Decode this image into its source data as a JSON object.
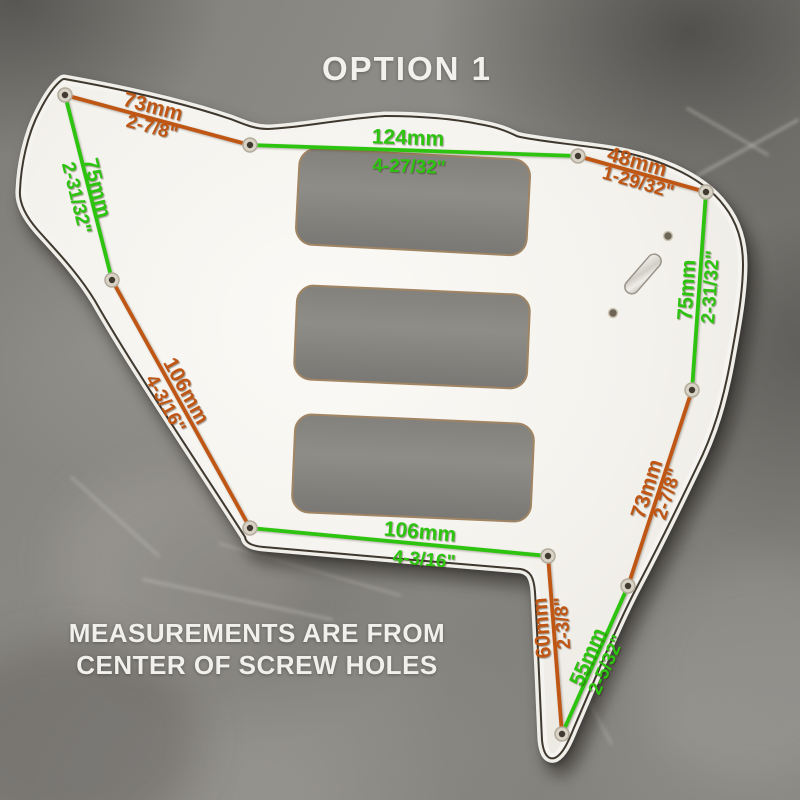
{
  "title": "OPTION 1",
  "footer": {
    "line1": "MEASUREMENTS ARE FROM",
    "line2": "CENTER OF SCREW HOLES"
  },
  "colors": {
    "orange": "#c05614",
    "green": "#2cc40f",
    "overlay_text": "#f2f1ee",
    "pickguard_white": "#f5f3ee",
    "ply_line": "#3f382e",
    "stone_gray": "#85837e"
  },
  "measurements": [
    {
      "name": "top-left-span",
      "color": "orange",
      "mm": "73mm",
      "inch": "2-7/8\"",
      "line": {
        "x1": 65,
        "y1": 95,
        "x2": 250,
        "y2": 145
      },
      "mm_label": {
        "x": 153,
        "y": 107,
        "rot": 15
      },
      "inch_label": {
        "x": 152,
        "y": 128,
        "rot": 15
      }
    },
    {
      "name": "neck-span",
      "color": "green",
      "mm": "124mm",
      "inch": "4-27/32\"",
      "line": {
        "x1": 250,
        "y1": 145,
        "x2": 578,
        "y2": 156
      },
      "mm_label": {
        "x": 408,
        "y": 138,
        "rot": 2
      },
      "inch_label": {
        "x": 409,
        "y": 167,
        "rot": 2
      }
    },
    {
      "name": "top-right-span",
      "color": "orange",
      "mm": "48mm",
      "inch": "1-29/32\"",
      "line": {
        "x1": 578,
        "y1": 156,
        "x2": 706,
        "y2": 192
      },
      "mm_label": {
        "x": 637,
        "y": 162,
        "rot": 16
      },
      "inch_label": {
        "x": 638,
        "y": 183,
        "rot": 16
      }
    },
    {
      "name": "left-edge-span",
      "color": "green",
      "mm": "75mm",
      "inch": "2-31/32\"",
      "line": {
        "x1": 65,
        "y1": 95,
        "x2": 112,
        "y2": 280
      },
      "mm_label": {
        "x": 97,
        "y": 188,
        "rot": 76
      },
      "inch_label": {
        "x": 76,
        "y": 198,
        "rot": 76
      }
    },
    {
      "name": "right-edge-span",
      "color": "green",
      "mm": "75mm",
      "inch": "2-31/32\"",
      "line": {
        "x1": 706,
        "y1": 192,
        "x2": 692,
        "y2": 390
      },
      "mm_label": {
        "x": 687,
        "y": 290,
        "rot": -86
      },
      "inch_label": {
        "x": 711,
        "y": 287,
        "rot": -86
      }
    },
    {
      "name": "lower-left-diagonal",
      "color": "orange",
      "mm": "106mm",
      "inch": "4-3/16\"",
      "line": {
        "x1": 112,
        "y1": 280,
        "x2": 250,
        "y2": 528
      },
      "mm_label": {
        "x": 186,
        "y": 391,
        "rot": 61
      },
      "inch_label": {
        "x": 165,
        "y": 404,
        "rot": 61
      }
    },
    {
      "name": "bottom-span",
      "color": "green",
      "mm": "106mm",
      "inch": "4-3/16\"",
      "line": {
        "x1": 250,
        "y1": 528,
        "x2": 548,
        "y2": 556
      },
      "mm_label": {
        "x": 420,
        "y": 532,
        "rot": 5
      },
      "inch_label": {
        "x": 424,
        "y": 560,
        "rot": 5
      }
    },
    {
      "name": "lower-right-diagonal",
      "color": "orange",
      "mm": "73mm",
      "inch": "2-7/8\"",
      "line": {
        "x1": 692,
        "y1": 390,
        "x2": 628,
        "y2": 586
      },
      "mm_label": {
        "x": 647,
        "y": 489,
        "rot": -72
      },
      "inch_label": {
        "x": 668,
        "y": 494,
        "rot": -72
      }
    },
    {
      "name": "tail-vertical",
      "color": "orange",
      "mm": "60mm",
      "inch": "2-3/8\"",
      "line": {
        "x1": 548,
        "y1": 556,
        "x2": 562,
        "y2": 734
      },
      "mm_label": {
        "x": 542,
        "y": 628,
        "rot": -94
      },
      "inch_label": {
        "x": 563,
        "y": 623,
        "rot": -94
      }
    },
    {
      "name": "tail-diagonal",
      "color": "green",
      "mm": "55mm",
      "inch": "2-5/32\"",
      "line": {
        "x1": 628,
        "y1": 586,
        "x2": 562,
        "y2": 734
      },
      "mm_label": {
        "x": 588,
        "y": 657,
        "rot": -66
      },
      "inch_label": {
        "x": 607,
        "y": 665,
        "rot": -66
      }
    }
  ],
  "screw_holes": [
    {
      "x": 65,
      "y": 95
    },
    {
      "x": 250,
      "y": 145
    },
    {
      "x": 578,
      "y": 156
    },
    {
      "x": 706,
      "y": 192
    },
    {
      "x": 692,
      "y": 390
    },
    {
      "x": 112,
      "y": 280
    },
    {
      "x": 250,
      "y": 528
    },
    {
      "x": 548,
      "y": 556
    },
    {
      "x": 628,
      "y": 586
    },
    {
      "x": 562,
      "y": 734
    }
  ],
  "pickup_cutouts": [
    {
      "cx": 413,
      "cy": 202,
      "w": 231,
      "h": 96,
      "rot": 3,
      "rx": 17
    },
    {
      "cx": 412,
      "cy": 337,
      "w": 233,
      "h": 94,
      "rot": 2.5,
      "rx": 17
    },
    {
      "cx": 413,
      "cy": 468,
      "w": 239,
      "h": 98,
      "rot": 2.5,
      "rx": 17
    }
  ],
  "hardware": {
    "switch_slot": {
      "cx": 643,
      "cy": 274,
      "w": 14,
      "h": 48,
      "rot": 41,
      "rx": 7
    },
    "small_holes": [
      {
        "x": 668,
        "y": 236,
        "r": 4.5
      },
      {
        "x": 613,
        "y": 313,
        "r": 4.5
      }
    ]
  }
}
